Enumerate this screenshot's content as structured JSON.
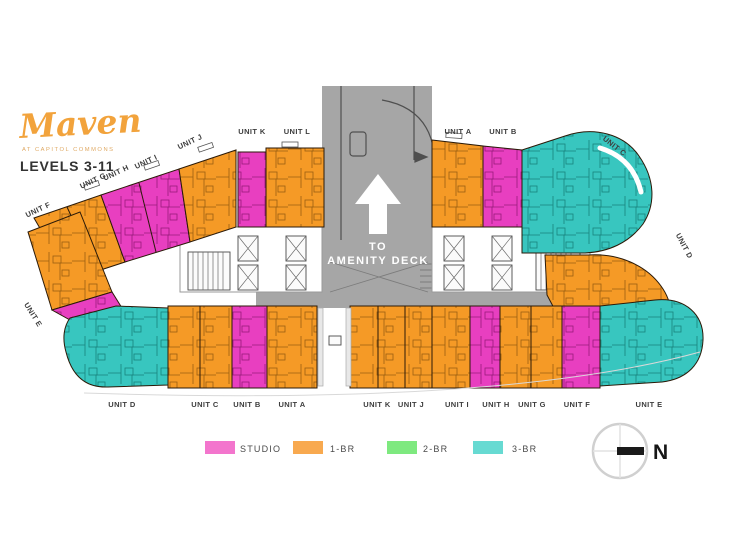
{
  "header": {
    "logo_text": "Maven",
    "logo_tagline": "AT CAPITOL COMMONS",
    "levels_label": "LEVELS 3-11"
  },
  "plan": {
    "amenity": {
      "line1": "TO",
      "line2": "AMENITY DECK"
    },
    "labels": {
      "top": [
        "UNIT K",
        "UNIT L",
        "UNIT A",
        "UNIT B"
      ],
      "diagonal": [
        "UNIT F",
        "UNIT G",
        "UNIT H",
        "UNIT I",
        "UNIT J"
      ],
      "right": [
        "UNIT C",
        "UNIT D"
      ],
      "left": [
        "UNIT E"
      ],
      "bottom": [
        "UNIT D",
        "UNIT C",
        "UNIT B",
        "UNIT A",
        "UNIT K",
        "UNIT J",
        "UNIT I",
        "UNIT H",
        "UNIT G",
        "UNIT F",
        "UNIT E"
      ]
    }
  },
  "legend": {
    "items": [
      {
        "label": "STUDIO",
        "color": "#f375cd"
      },
      {
        "label": "1-BR",
        "color": "#f8a94f"
      },
      {
        "label": "2-BR",
        "color": "#7ee97f"
      },
      {
        "label": "3-BR",
        "color": "#67dad2"
      }
    ]
  },
  "compass": {
    "north_label": "N"
  },
  "colors": {
    "studio": "#e83fc0",
    "one_br": "#f59a26",
    "three_br": "#38c6bf",
    "corridor": "#a6a6a6",
    "logo": "#f2a33c"
  }
}
